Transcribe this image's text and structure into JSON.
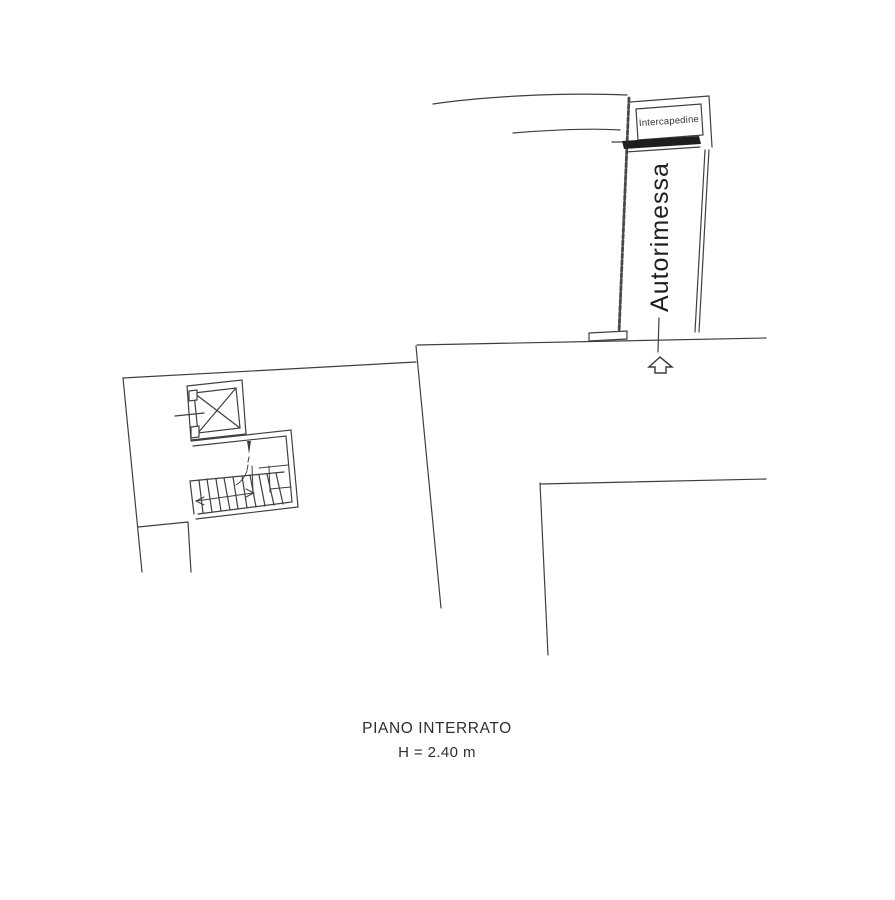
{
  "plan": {
    "title": "PIANO INTERRATO",
    "height_note": "H = 2.40 m"
  },
  "rooms": {
    "garage_label": "Autorimessa",
    "cavity_label": "Intercapedine"
  },
  "icons": {
    "ramp_direction_arrow": "up-block-arrow-icon",
    "elevator_cross": "x-cross-icon",
    "stair_walk_arrows": "direction-arrowheads"
  },
  "colors": {
    "background": "#ffffff",
    "line": "#3f3f3f",
    "text": "#2b2b2b",
    "wall_fill": "#1e1e1e"
  }
}
